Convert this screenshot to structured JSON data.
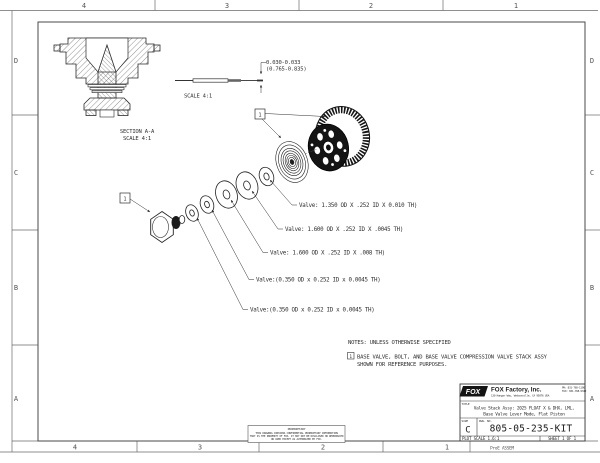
{
  "sheet": {
    "zones": {
      "columns": [
        "4",
        "3",
        "2",
        "1"
      ],
      "rows": [
        "D",
        "C",
        "B",
        "A"
      ],
      "plot_label": "ProE ASSEM"
    },
    "flag_number": "1",
    "section_view": {
      "label_line1": "SECTION A-A",
      "label_line2": "SCALE 4:1"
    },
    "needle_detail": {
      "dim_line1": "0.030-0.033",
      "dim_line2": "(0.765-0.835)",
      "scale_label": "SCALE 4:1"
    },
    "valve_labels": [
      "Valve: 1.350 OD X .252 ID X 0.010 TH)",
      "Valve: 1.600 OD X .252 ID X .0045 TH)",
      "Valve: 1.600 OD X .252 ID X .008 TH)",
      "Valve:(0.350 OD x 0.252 ID x 0.0045 TH)",
      "Valve:(0.350 OD x 0.252 ID x 0.0045 TH)"
    ],
    "notes": {
      "heading": "NOTES: UNLESS OTHERWISE SPECIFIED",
      "note1_line1": "BASE VALVE, BOLT, AND BASE VALVE COMPRESSION VALVE STACK ASSY",
      "note1_line2": "SHOWN FOR REFERENCE PURPOSES."
    },
    "title_block": {
      "logo": "FOX",
      "company": "FOX Factory, Inc.",
      "address": "130 Hangar Way, Watsonville, CA 95076 USA",
      "phone": "PH: 831-768-1100",
      "fax": "FAX: 831-768-9342",
      "title_label": "TITLE",
      "title_line1": "Valve Stack Assy: 2025 FLOAT X & DHX, LML,",
      "title_line2": "Base Valve Lever Mode, Flat Piston",
      "size_label": "SIZE",
      "size": "C",
      "dwg_label": "DWG. NO.",
      "dwg_no": "805-05-235-KIT",
      "plot_scale": "PLOT SCALE 1.6:1",
      "sheet_label": "SHEET 1 OF 1"
    },
    "proprietary": {
      "heading": "PROPRIETARY",
      "line1": "THIS DRAWING CONTAINS CONFIDENTIAL PROPRIETARY INFORMATION",
      "line2": "THAT IS THE PROPERTY OF FOX. IT MAY NOT BE DISCLOSED OR REPRODUCED",
      "line3": "OR USED EXCEPT AS AUTHORIZED BY FOX."
    }
  }
}
